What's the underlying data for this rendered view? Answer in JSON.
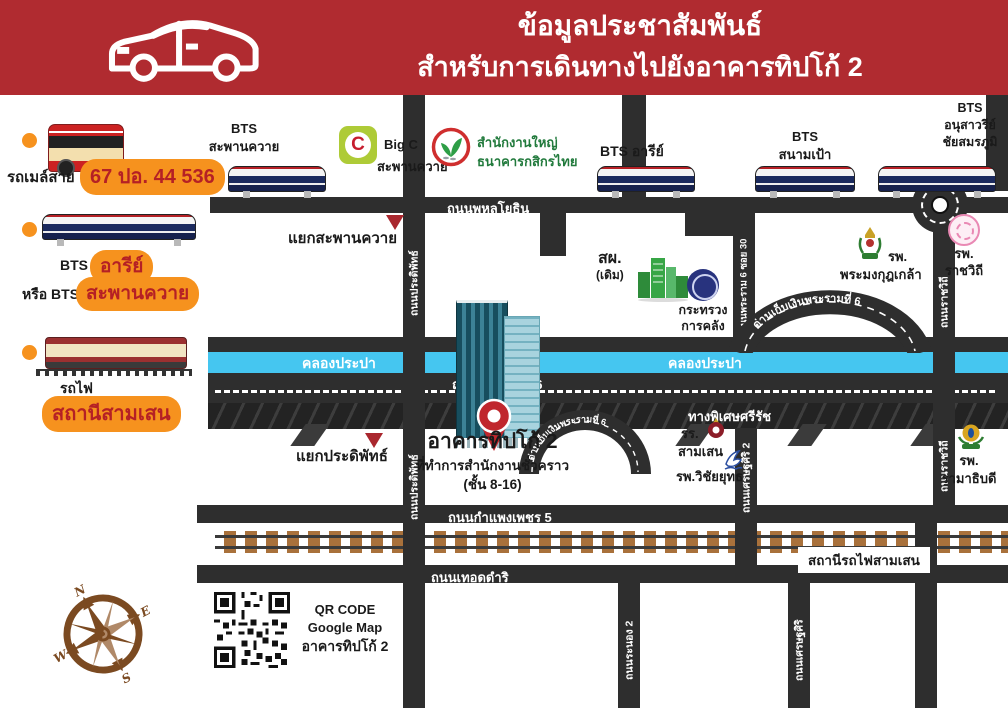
{
  "header": {
    "title_line1": "ข้อมูลประชาสัมพันธ์",
    "title_line2": "สำหรับการเดินทางไปยังอาคารทิปโก้ 2"
  },
  "sidebar": {
    "bus_label": "รถเมล์สาย",
    "bus_badge": "67 ปอ. 44 536",
    "bts_line1_label": "BTS",
    "bts_line1_badge": "อารีย์",
    "bts_line2_label": "หรือ BTS",
    "bts_line2_badge": "สะพานควาย",
    "train_label": "รถไฟ",
    "train_badge": "สถานีสามเสน"
  },
  "map": {
    "bts_stations": {
      "saphan_khwai_1": "BTS",
      "saphan_khwai_2": "สะพานควาย",
      "ari": "BTS อารีย์",
      "sanam_pao_1": "BTS",
      "sanam_pao_2": "สนามเป้า",
      "victory_1": "BTS",
      "victory_2": "อนุสาวรีย์",
      "victory_3": "ชัยสมรภูมิ"
    },
    "pois": {
      "bigc_glyph": "C",
      "bigc_1": "Big C",
      "bigc_2": "สะพานควาย",
      "kbank_1": "สำนักงานใหญ่",
      "kbank_2": "ธนาคารกสิกรไทย",
      "sorphor_1": "สผ.",
      "sorphor_2": "(เดิม)",
      "mof_1": "กระทรวง",
      "mof_2": "การคลัง",
      "phramongkut_1": "รพ.",
      "phramongkut_2": "พระมงกุฎเกล้า",
      "ratchawithi_1": "รพ.",
      "ratchawithi_2": "ราชวิถี",
      "ramathibodi_1": "รพ.",
      "ramathibodi_2": "รามาธิบดี",
      "samsen_school_1": "รร.",
      "samsen_school_2": "สามเสน",
      "vichaiyut": "รพ.วิชัยยุทธ",
      "samsen_station": "สถานีรถไฟสามเสน"
    },
    "junctions": {
      "saphan_khwai": "แยกสะพานควาย",
      "pradiphat": "แยกประดิพัทธ์"
    },
    "roads": {
      "phahonyothin": "ถนนพหลโยธิน",
      "pradiphat": "ถนนประดิพัทธ์",
      "rama6_soi30": "ถนนพระราม 6 ซอย 30",
      "ratchawithi": "ถนนราชวิถี",
      "canal": "คลองประปา",
      "rama6": "ถนนพระรามที่ 6",
      "sirat_expressway": "ทางพิเศษศรีรัช",
      "toll_gate": "ด่านเก็บเงินพระรามที่ 6",
      "setthasiri2": "ถนนเศรษฐศิริ 2",
      "setthasiri": "ถนนเศรษฐศิริ",
      "ranong2": "ถนนระนอง 2",
      "kamphaengphet5": "ถนนกำแพงเพชร 5",
      "thoetdamri": "ถนนเทอดดำริ"
    },
    "tipco": {
      "name": "อาคารทิปโก้ 2",
      "desc": "ที่ทำการสำนักงานชั่วคราว",
      "floors": "(ชั้น 8-16)"
    }
  },
  "qr": {
    "line1": "QR CODE",
    "line2": "Google Map",
    "line3": "อาคารทิปโก้ 2"
  },
  "compass": {
    "n": "N",
    "e": "E",
    "s": "S",
    "w": "W"
  },
  "colors": {
    "header_red": "#b02b30",
    "accent_orange": "#f6921e",
    "badge_text_red": "#b52025",
    "road_dark": "#2e2e2e",
    "canal_blue": "#45c6f0",
    "rail_brown": "#a9713b",
    "compass_brown": "#7b4a21"
  }
}
